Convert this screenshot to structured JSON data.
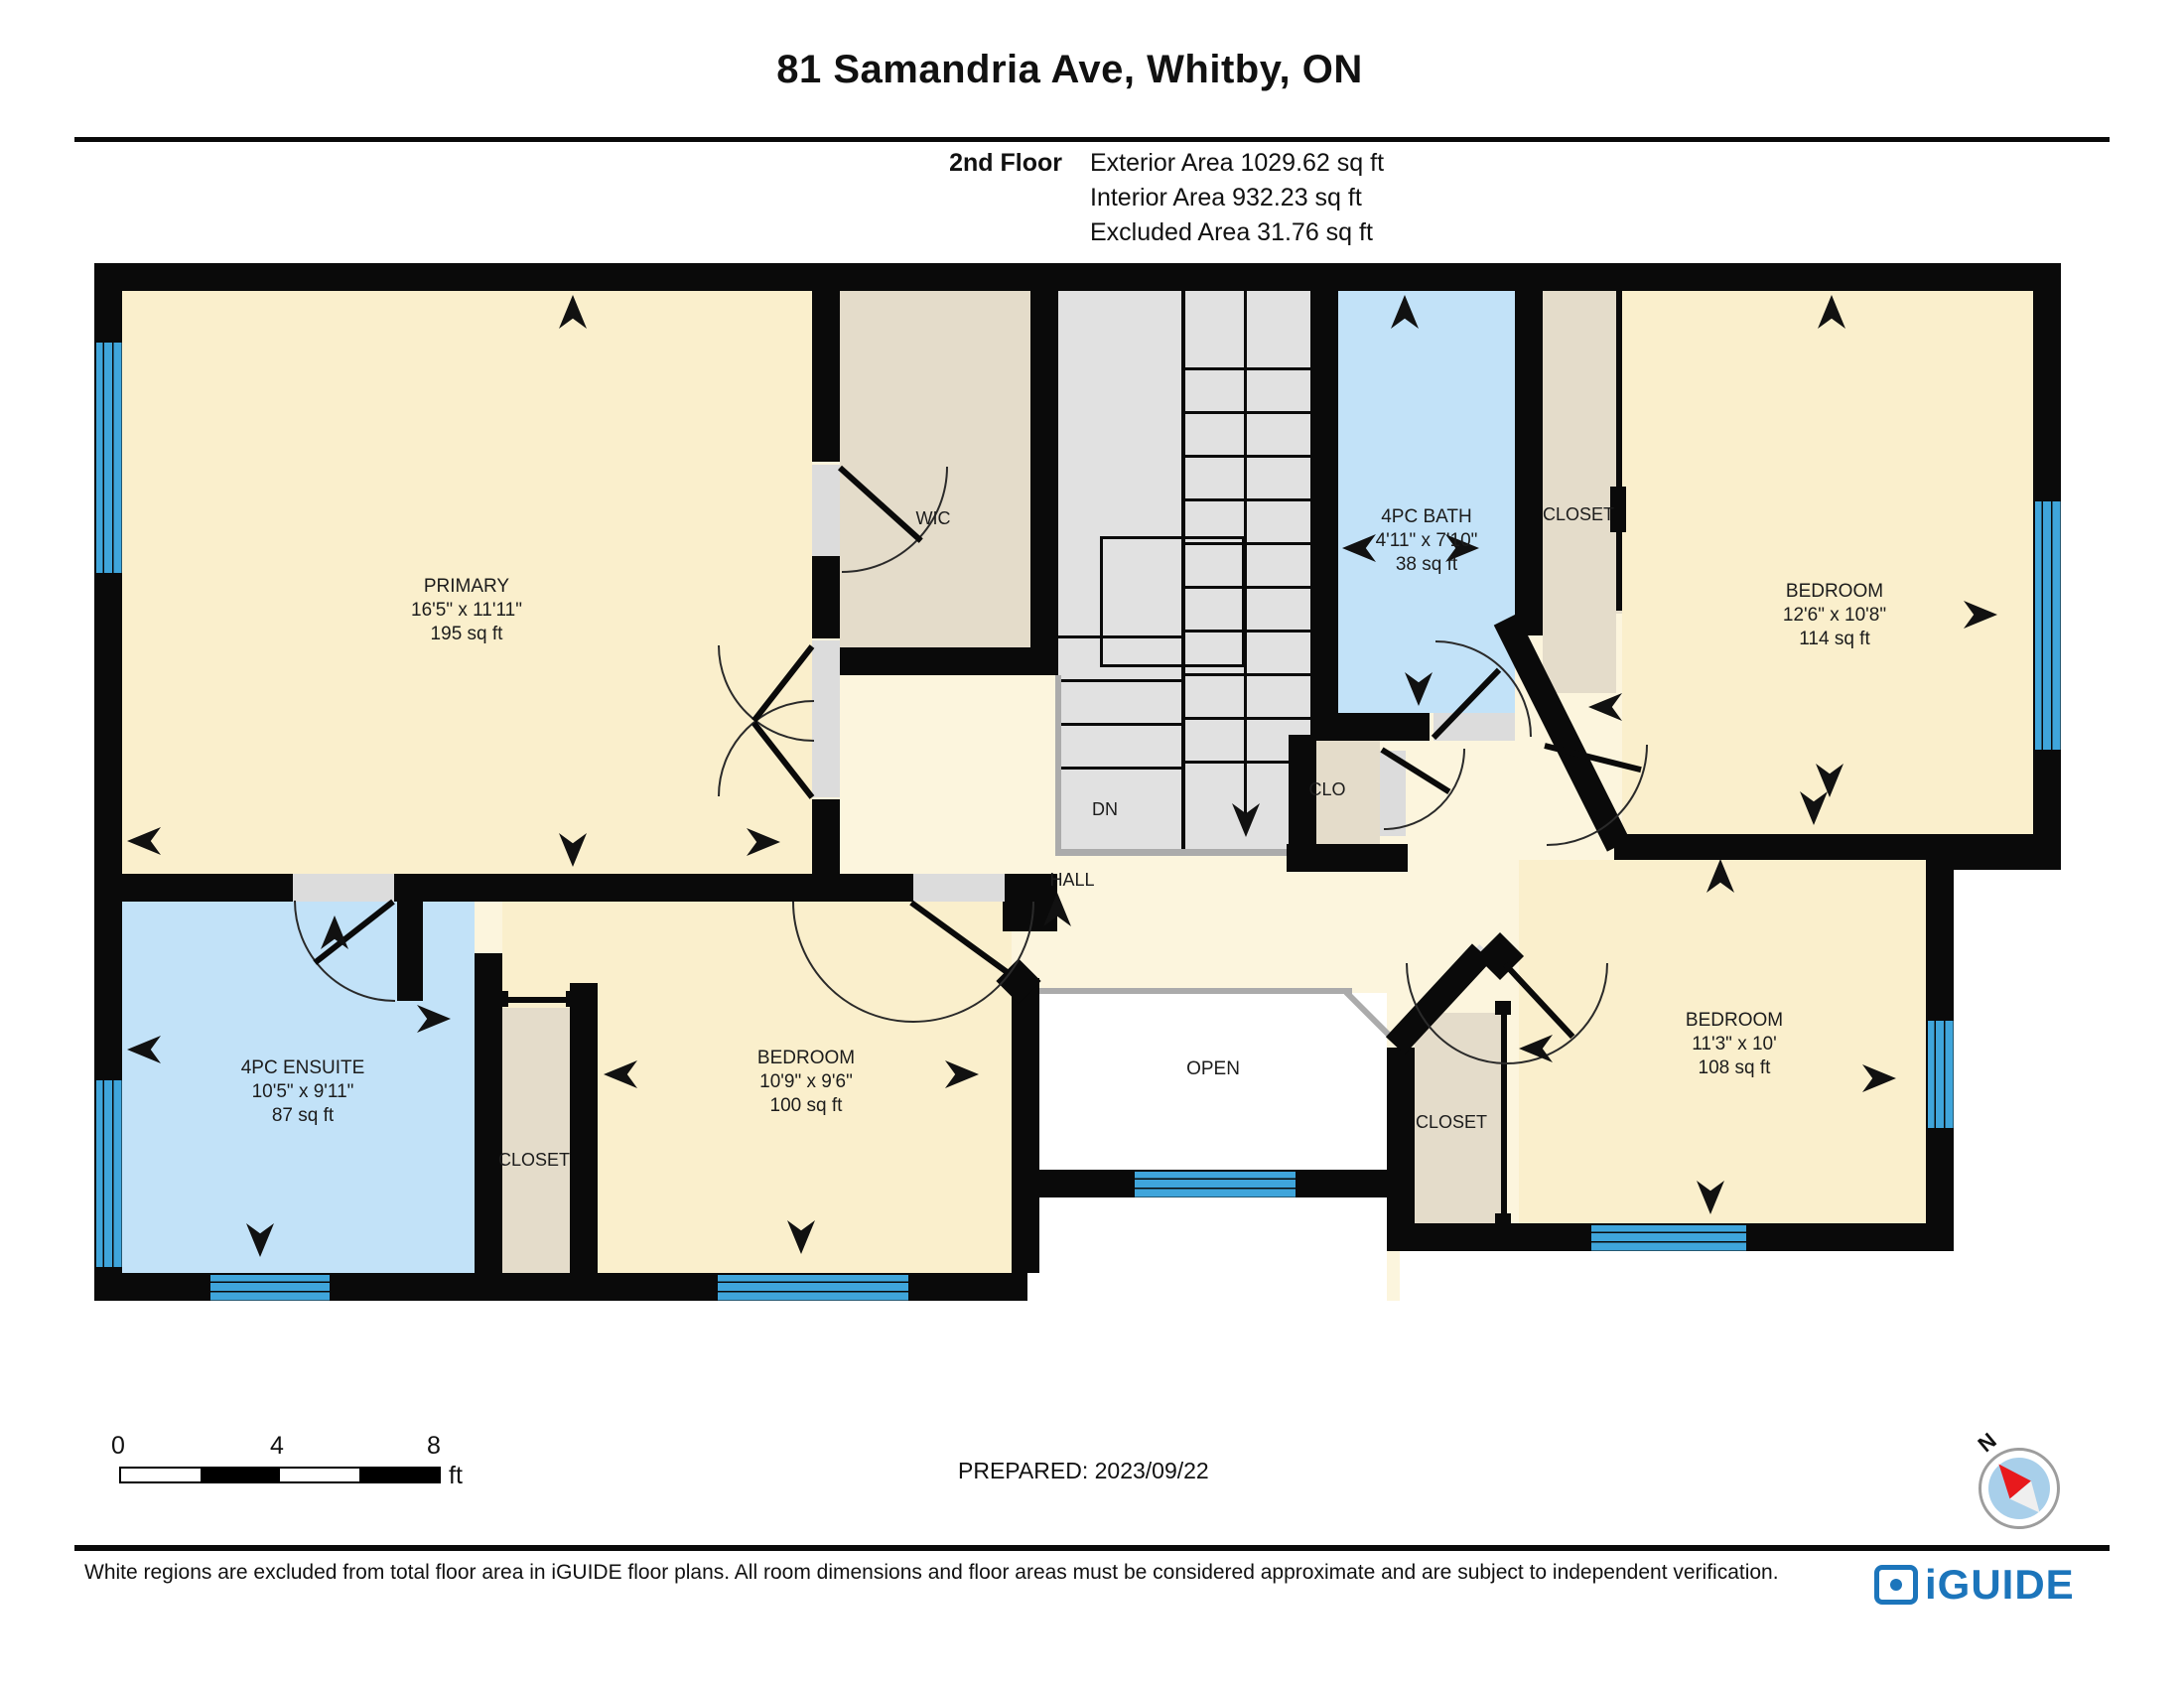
{
  "header": {
    "title": "81 Samandria Ave, Whitby, ON",
    "floor_label": "2nd Floor",
    "areas": [
      "Exterior Area 1029.62 sq ft",
      "Interior Area 932.23 sq ft",
      "Excluded Area 31.76 sq ft"
    ]
  },
  "rooms": {
    "primary": {
      "name": "PRIMARY",
      "dims": "16'5\" x 11'11\"",
      "area": "195 sq ft"
    },
    "wic": {
      "name": "WIC"
    },
    "bath": {
      "name": "4PC BATH",
      "dims": "4'11\" x 7'10\"",
      "area": "38 sq ft"
    },
    "closet_top": {
      "name": "CLOSET"
    },
    "bedroom_ne": {
      "name": "BEDROOM",
      "dims": "12'6\" x 10'8\"",
      "area": "114 sq ft"
    },
    "ensuite": {
      "name": "4PC ENSUITE",
      "dims": "10'5\" x 9'11\"",
      "area": "87 sq ft"
    },
    "closet_sw": {
      "name": "CLOSET"
    },
    "bedroom_s": {
      "name": "BEDROOM",
      "dims": "10'9\" x 9'6\"",
      "area": "100 sq ft"
    },
    "open": {
      "name": "OPEN"
    },
    "closet_se": {
      "name": "CLOSET"
    },
    "bedroom_se": {
      "name": "BEDROOM",
      "dims": "11'3\" x 10'",
      "area": "108 sq ft"
    },
    "hall": {
      "name": "HALL"
    },
    "dn": {
      "name": "DN"
    },
    "clo": {
      "name": "CLO"
    }
  },
  "footer": {
    "scale_ticks": [
      "0",
      "4",
      "8"
    ],
    "scale_unit": "ft",
    "prepared": "PREPARED: 2023/09/22",
    "compass_label": "N",
    "disclaimer": "White regions are excluded from total floor area in iGUIDE floor plans. All room dimensions and floor areas must be considered approximate and are subject to independent verification.",
    "logo_text": "iGUIDE"
  },
  "colors": {
    "wall": "#0a0a0a",
    "room_cream": "#faefcc",
    "hall_cream": "#fcf5dd",
    "closet_tan": "#e4dcca",
    "bath_blue": "#c2e2f8",
    "stairs_gray": "#e1e1e1",
    "window_blue": "#3fa5db",
    "excluded_white": "#ffffff",
    "logo_blue": "#1c75bb",
    "compass_red": "#e8191c"
  }
}
